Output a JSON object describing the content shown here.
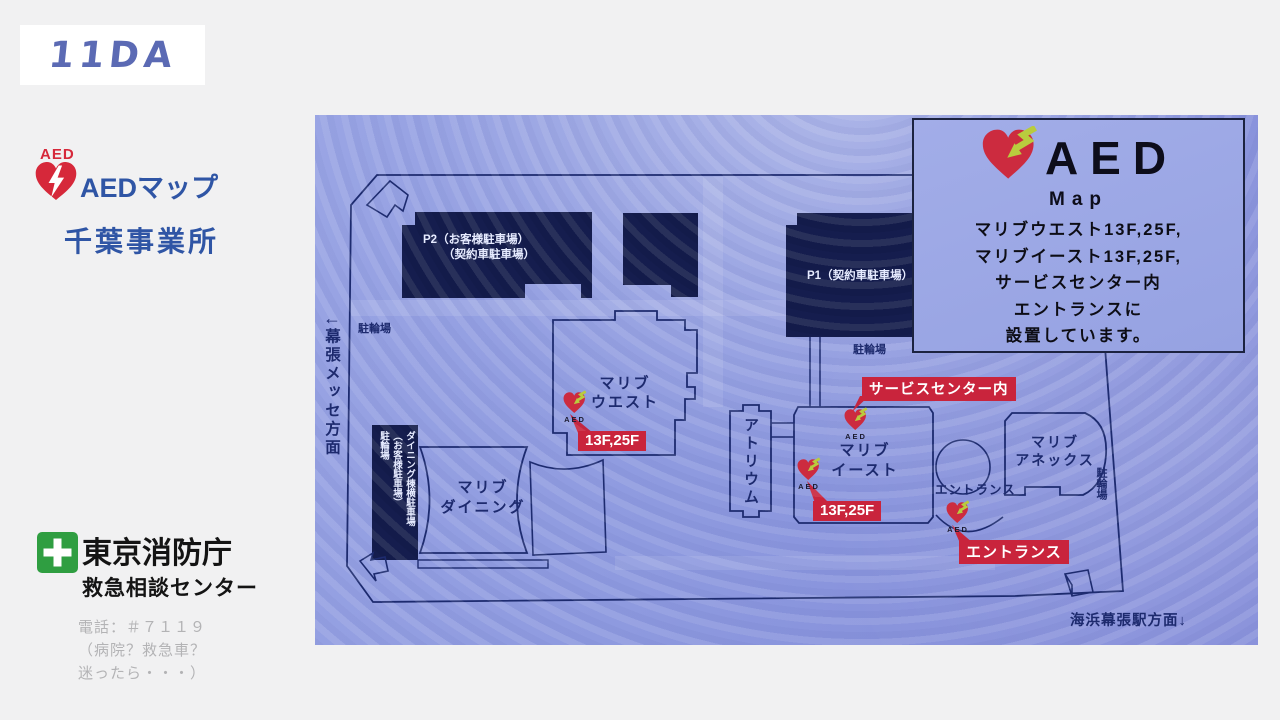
{
  "logo": {
    "text": "11DA"
  },
  "header": {
    "aed_tag": "AED",
    "title": "AEDマップ",
    "subtitle": "千葉事業所"
  },
  "footer": {
    "org": "東京消防庁",
    "org_sub": "救急相談センター",
    "phone": [
      "電話：＃７１１９",
      "（病院？救急車？",
      "迷ったら・・・）"
    ]
  },
  "map": {
    "legend": {
      "aed": "AED",
      "map_word": "Map",
      "lines": [
        "マリブウエスト13F,25F,",
        "マリブイースト13F,25F,",
        "サービスセンター内",
        "エントランスに",
        "設置しています。"
      ]
    },
    "buildings": {
      "p2_line1": "P2（お客様駐車場）",
      "p2_line2": "（契約車駐車場）",
      "p1": "P1（契約車駐車場）",
      "west_line1": "マリブ",
      "west_line2": "ウエスト",
      "dining_line1": "マリブ",
      "dining_line2": "ダイニング",
      "east_line1": "マリブ",
      "east_line2": "イースト",
      "annex_line1": "マリブ",
      "annex_line2": "アネックス",
      "atrium": "アトリウム",
      "dining_parking_lines": [
        "ダイニング棟横駐車場",
        "（お客様駐車場）",
        "駐輪場"
      ]
    },
    "labels": {
      "bike_nw": "駐輪場",
      "bike_p1": "駐輪場",
      "bike_east": "駐輪場",
      "entrance_plain": "エントランス",
      "makuhari_arrow": "←",
      "makuhari": "幕張メッセ方面",
      "station": "海浜幕張駅方面↓"
    },
    "markers": {
      "aed_caption": "AED",
      "west_floors": "13F,25F",
      "east_floors": "13F,25F",
      "service_center": "サービスセンター内",
      "entrance": "エントランス"
    }
  },
  "colors": {
    "accent_red": "#c9243c",
    "heart_red": "#cc2b3f",
    "bolt_green": "#b9cc3e",
    "navy_line": "#1c2a6e",
    "building_navy": "#131b4a",
    "blue_text": "#2f55a5",
    "cross_green": "#2f9e41"
  }
}
